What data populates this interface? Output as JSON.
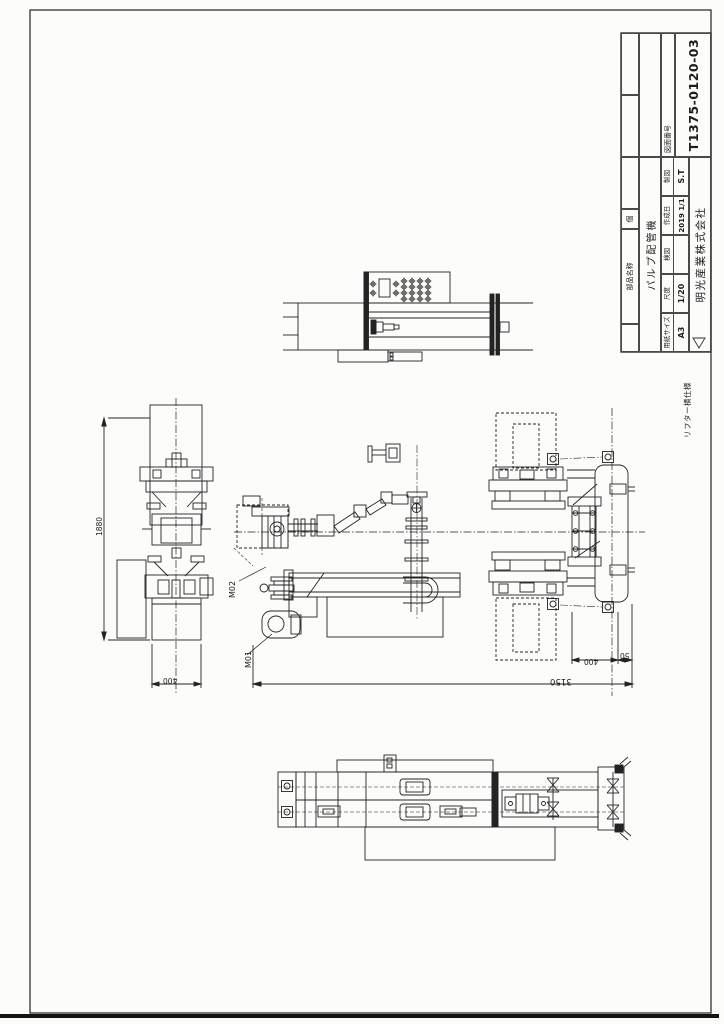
{
  "title_block": {
    "bom_headers": {
      "part_name": "部品名称",
      "qty": "個"
    },
    "title": "パルプ配管機",
    "drawing_number_label": "図面番号",
    "drawing_number": "T1375-0120-03",
    "company": "明光産業株式会社",
    "fields": {
      "paper_size_label": "用紙サイズ",
      "paper_size": "A3",
      "scale_label": "尺度",
      "scale": "1/20",
      "check_label": "検図",
      "check": "",
      "date_label": "作成日",
      "date": "2019 1/1",
      "drafter_label": "製図",
      "drafter": "S.T"
    }
  },
  "notes": {
    "spec": "リフター横仕様"
  },
  "callouts": {
    "m01": "M01",
    "m02": "M02"
  },
  "dimensions": {
    "overall_length": "3150",
    "frame_width": "400",
    "frame_offset": "50",
    "column_height": "1880",
    "base_width": "400"
  }
}
